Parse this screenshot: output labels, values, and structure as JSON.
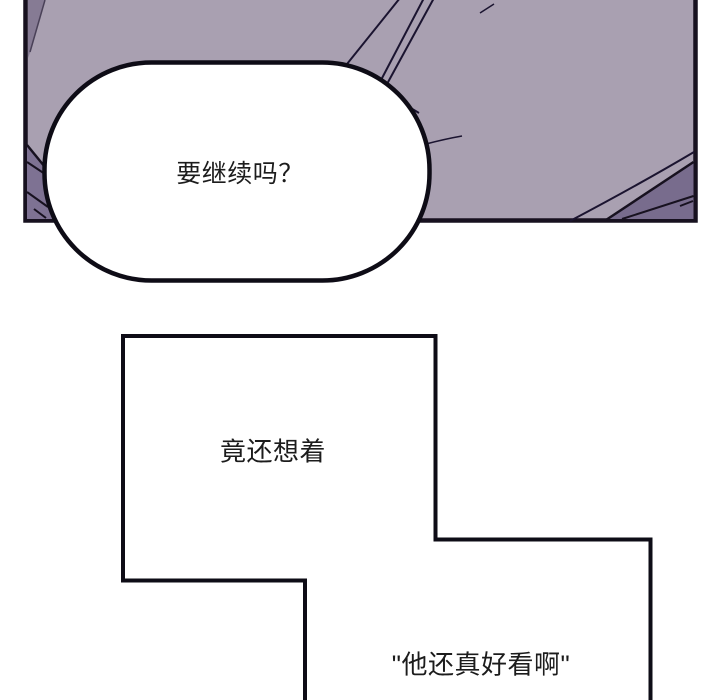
{
  "panel": {
    "description": "purple illustrated comic panel",
    "palette": {
      "panel_light_purple": "#a9a0b1",
      "panel_shadow_purple": "#7e7293",
      "panel_wedge_purple": "#867b94",
      "panel_corner_purple": "#786c8d",
      "line_black": "#17111f",
      "bubble_fill": "#ffffff",
      "text_color": "#1c1c1c"
    }
  },
  "speech_bubble": {
    "text": "要继续吗？"
  },
  "narration_box": {
    "text": "竟还想着"
  },
  "quote_box": {
    "text": "\"他还真好看啊\""
  }
}
